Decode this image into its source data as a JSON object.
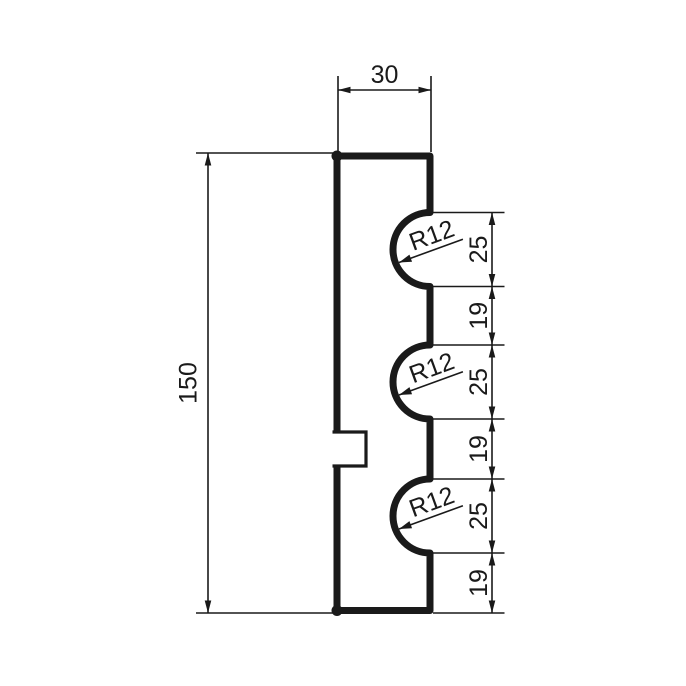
{
  "drawing": {
    "background_color": "#ffffff",
    "line_color": "#1a1a1a",
    "profile": {
      "width_label": "30",
      "height_label": "150"
    },
    "right_dimensions": [
      "25",
      "19",
      "25",
      "19",
      "25",
      "19"
    ],
    "radius_labels": [
      "R12",
      "R12",
      "R12"
    ]
  }
}
